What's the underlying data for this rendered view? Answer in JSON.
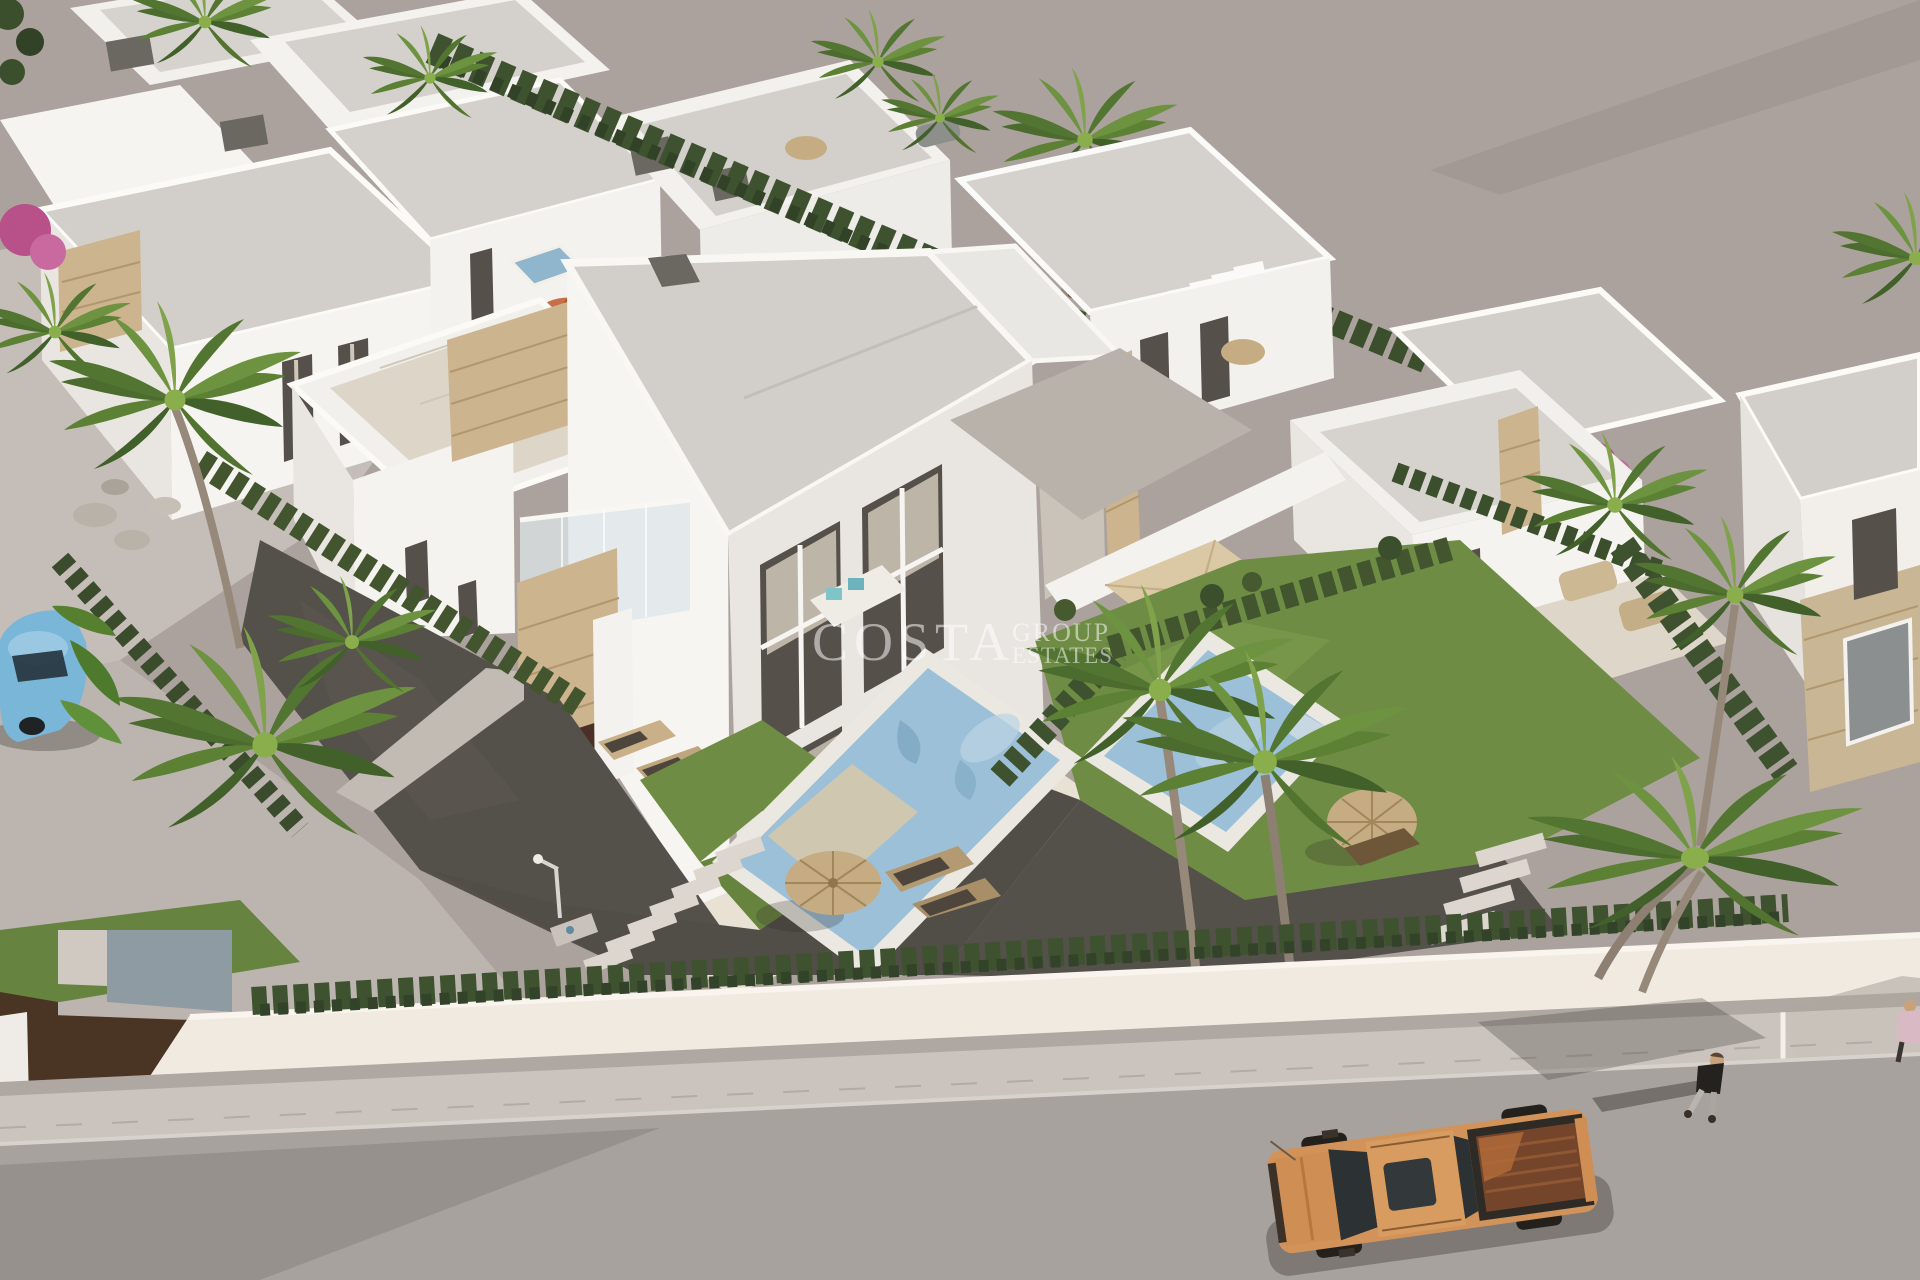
{
  "meta": {
    "title": "Aerial 3D render of a new-build villa development",
    "description": "Bird's-eye architectural rendering of modern white flat-roof villas with travertine stone accents, private pools, gravel gardens, palm trees, cypress hedges, a white perimeter wall along a grey street with an orange pickup truck, a pedestrian and a light-blue parked car.",
    "width": 1920,
    "height": 1280
  },
  "watermark": {
    "line1": "COSTA",
    "line2": "GROUP",
    "line3": "ESTATES",
    "color": "#ffffff",
    "opacity": "0.52"
  },
  "palette": {
    "ground": "#aba29d",
    "pavement_light": "#c5beb8",
    "road": "#a8a29e",
    "sidewalk": "#cbc4be",
    "wall": "#f0eae1",
    "gate_corten": "#4a3423",
    "roof_grey": "#d2cfca",
    "villa_sun": "#f7f5f1",
    "villa_shade": "#e9e6e2",
    "parapet": "#fbfaf7",
    "stone": "#ccb48e",
    "window_dark": "#56504a",
    "curtain": "#cfc7b8",
    "glass_dark": "#2c3134",
    "hedge": "#3f5230",
    "hedge_dark": "#324226",
    "grass": "#6e8c44",
    "gravel_dark": "#54504a",
    "terrace_cream": "#e9e2d4",
    "pool_water": "#9cc0d8",
    "pool_coping": "#ebe8e2",
    "beach_ledge": "#d3c7ae",
    "palm_green": "#5c8034",
    "palm_dark": "#41602a",
    "palm_trunk": "#96897a",
    "thatch": "#c6ac82",
    "umbrella_orange": "#c96f45",
    "truck_body": "#d2935a",
    "truck_bed": "#74452a",
    "tyre": "#24211d",
    "car_blue": "#7ab6d7",
    "shadow": "rgba(50,45,40,0.35)"
  }
}
